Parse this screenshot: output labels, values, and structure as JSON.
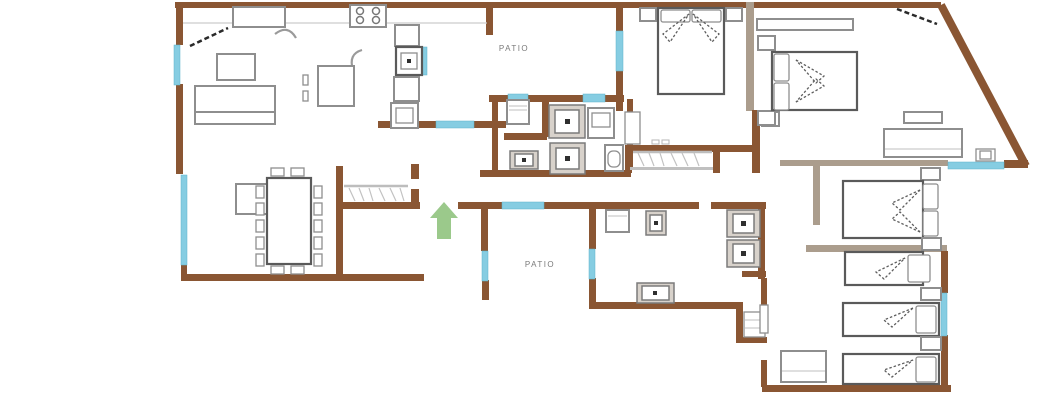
{
  "labels": {
    "patio_upper": "PATIO",
    "patio_lower": "PATIO"
  },
  "icons": {
    "entrance_arrow": "up-arrow",
    "door_swing": "dashed-diagonal-line"
  },
  "colors": {
    "background": "#ffffff",
    "wall": "#8a5633",
    "wall_tan": "#ab9d8d",
    "window": "#86cde2",
    "furniture": "#8e8e8e",
    "furniture_dark": "#5a5a5a",
    "arrow": "#9bc98b",
    "label": "#7a7a7a",
    "door_dash": "#2a2a2a"
  }
}
